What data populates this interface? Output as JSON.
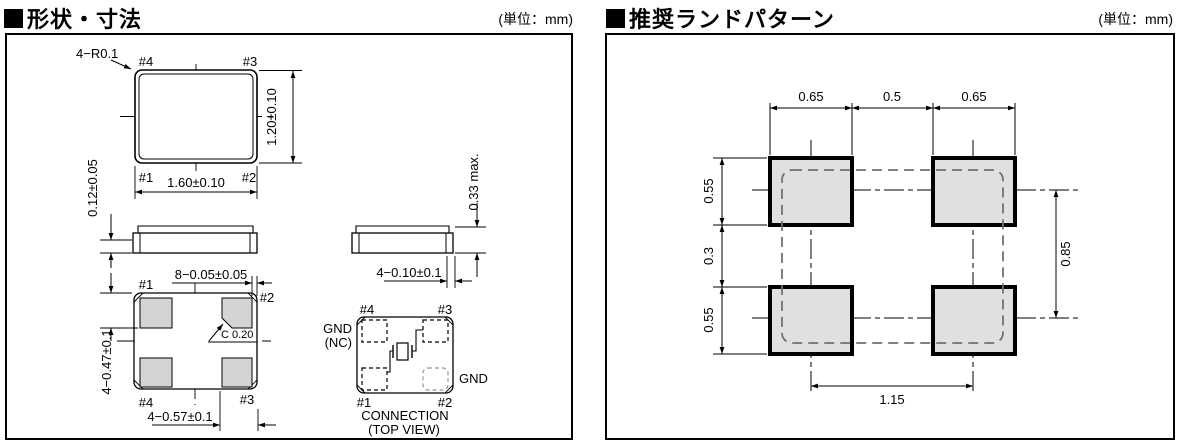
{
  "left": {
    "title": "形状・寸法",
    "unit": "(単位：mm)",
    "top_view": {
      "corner_note": "4−R0.1",
      "pin_tl": "#4",
      "pin_tr": "#3",
      "pin_bl": "#1",
      "pin_br": "#2",
      "width": "1.60±0.10",
      "height": "1.20±0.10"
    },
    "front_view": {
      "terminal_thickness": "0.12±0.05"
    },
    "side_view": {
      "height_max": "0.33 max.",
      "castellation_width": "4−0.10±0.1"
    },
    "bottom_view": {
      "pin_tl": "#1",
      "pin_tr": "#2",
      "pin_bl": "#4",
      "pin_br": "#3",
      "edge_clearance": "8−0.05±0.05",
      "pad_height": "4−0.47±0.1",
      "pad_width": "4−0.57±0.1",
      "chamfer": "C  0.20"
    },
    "connection": {
      "pin_tl": "#4",
      "pin_tr": "#3",
      "pin_bl": "#1",
      "pin_br": "#2",
      "gnd_nc_1": "GND",
      "gnd_nc_2": "(NC)",
      "gnd": "GND",
      "caption_1": "CONNECTION",
      "caption_2": "(TOP VIEW)"
    }
  },
  "right": {
    "title": "推奨ランドパターン",
    "unit": "(単位：mm)",
    "dims": {
      "pad_w_left": "0.65",
      "pad_gap_h": "0.5",
      "pad_w_right": "0.65",
      "pad_h_top": "0.55",
      "pad_gap_v": "0.3",
      "pad_h_bottom": "0.55",
      "pitch_v": "0.85",
      "pitch_h": "1.15"
    }
  },
  "colors": {
    "line": "#000000",
    "pad_fill_left": "#d4d4d4",
    "pad_fill_right": "#e0e0e0",
    "dashed_outline": "#707070"
  }
}
